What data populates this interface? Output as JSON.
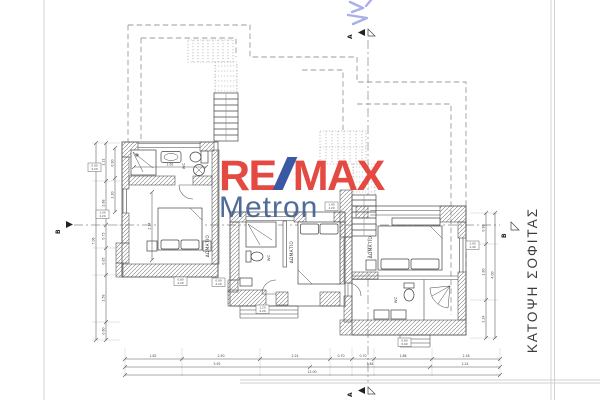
{
  "title": {
    "drawing_label": "ΚΑΤΟΨΗ ΣΟΦΙΤΑΣ"
  },
  "logo": {
    "re": "RE",
    "max": "MAX",
    "metron": "Metron",
    "remax_red": "#e23b32",
    "slash_blue": "#2b4a9e",
    "metron_blue": "#40608f"
  },
  "markers": {
    "a": "Α",
    "b": "Β"
  },
  "rooms": {
    "bedroom": "ΔΩΜΑΤΙΟ",
    "wc": "WC"
  },
  "dims": {
    "bottom_row1": [
      "1.82",
      "2.50",
      "2.24",
      "0.70",
      "0.70",
      "1.86",
      "2.18"
    ],
    "bottom_row2": [
      "5.92",
      "3.84",
      "2.24"
    ],
    "bottom_total": "12.00",
    "left_inner": [
      "1.21",
      "2.68",
      "0.75",
      "0.85",
      "1.58",
      "0.60"
    ],
    "left_total": "7.06",
    "left_small": [
      "0.90",
      "1.30"
    ],
    "right_inner": [
      "0.98",
      "1.80",
      "2.24"
    ],
    "right_total": "4.00",
    "bath_width": "2.62",
    "bed_wall": "2.24"
  },
  "tags": [
    {
      "a": "0.90",
      "b": "2.20"
    },
    {
      "a": "1.00",
      "b": "2.20"
    },
    {
      "a": "0.80",
      "b": "2.20"
    },
    {
      "a": "0.90",
      "b": "2.20"
    },
    {
      "a": "1.20",
      "b": "2.20"
    },
    {
      "a": "1.40",
      "b": "1.20"
    },
    {
      "a": "1.00",
      "b": "1.40"
    },
    {
      "a": "0.80",
      "b": "0.60"
    }
  ]
}
